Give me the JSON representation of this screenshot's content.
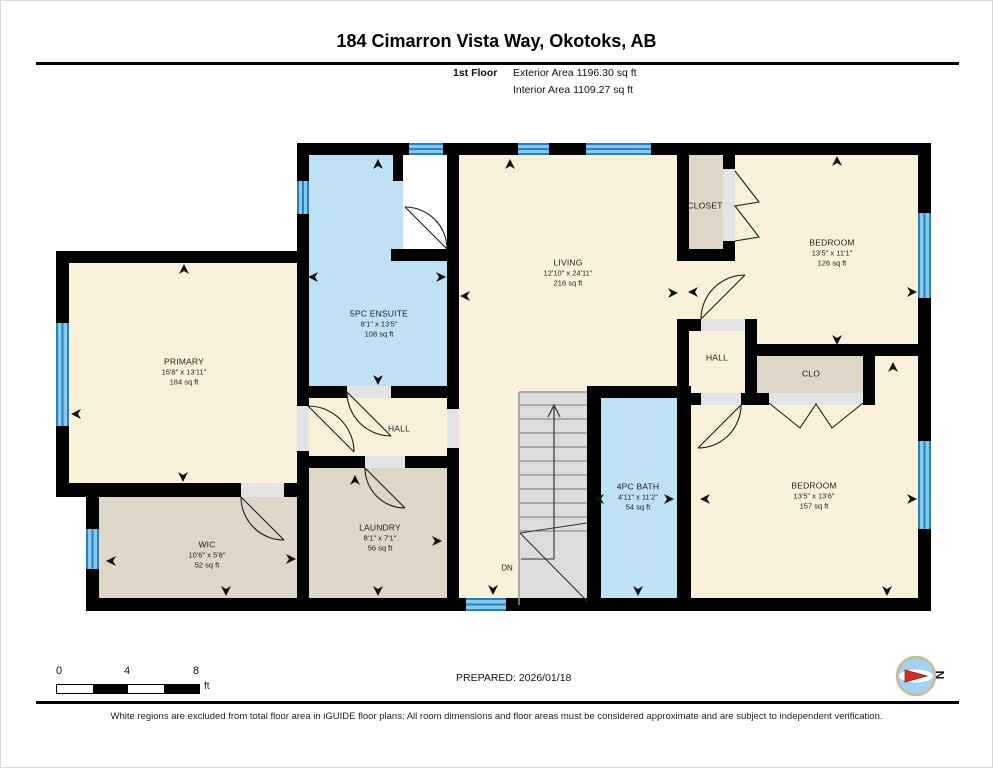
{
  "header": {
    "title": "184 Cimarron Vista Way, Okotoks, AB",
    "floor_label": "1st Floor",
    "exterior_area": "Exterior Area 1196.30 sq ft",
    "interior_area": "Interior Area 1109.27 sq ft"
  },
  "rooms": {
    "primary": {
      "name": "PRIMARY",
      "dims": "15'8\" x 13'11\"",
      "area": "184 sq ft"
    },
    "ensuite": {
      "name": "5PC ENSUITE",
      "dims": "8'1\" x 13'5\"",
      "area": "108 sq ft"
    },
    "living": {
      "name": "LIVING",
      "dims": "12'10\" x 24'11\"",
      "area": "216 sq ft"
    },
    "closet_top": {
      "name": "CLOSET"
    },
    "bedroom_upper": {
      "name": "BEDROOM",
      "dims": "13'5\" x 11'1\"",
      "area": "126 sq ft"
    },
    "hall_right": {
      "name": "HALL"
    },
    "clo": {
      "name": "CLO"
    },
    "bedroom_lower": {
      "name": "BEDROOM",
      "dims": "13'5\" x 13'6\"",
      "area": "157 sq ft"
    },
    "bath": {
      "name": "4PC BATH",
      "dims": "4'11\" x 11'2\"",
      "area": "54 sq ft"
    },
    "hall_center": {
      "name": "HALL"
    },
    "laundry": {
      "name": "LAUNDRY",
      "dims": "8'1\" x 7'1\"",
      "area": "56 sq ft"
    },
    "wic": {
      "name": "WIC",
      "dims": "10'6\" x 5'8\"",
      "area": "52 sq ft"
    }
  },
  "stairs": {
    "down_label": "DN"
  },
  "scale_bar": {
    "ticks": [
      "0",
      "4",
      "8"
    ],
    "unit": "ft"
  },
  "compass": {
    "north_label": "N"
  },
  "footer": {
    "prepared": "PREPARED: 2026/01/18",
    "disclaimer": "White regions are excluded from total floor area in iGUIDE floor plans. All room dimensions and floor areas must be considered approximate and are subject to independent verification."
  },
  "colors": {
    "room_cream": "#FAF1DB",
    "room_blue": "#BFE1F6",
    "room_tan": "#DED6C7",
    "stairs_grey": "#DCDCDC",
    "window_blue": "#85C9EF",
    "window_frame_blue": "#2E7FB8",
    "wall_black": "#000000",
    "compass_red": "#CC3322"
  }
}
